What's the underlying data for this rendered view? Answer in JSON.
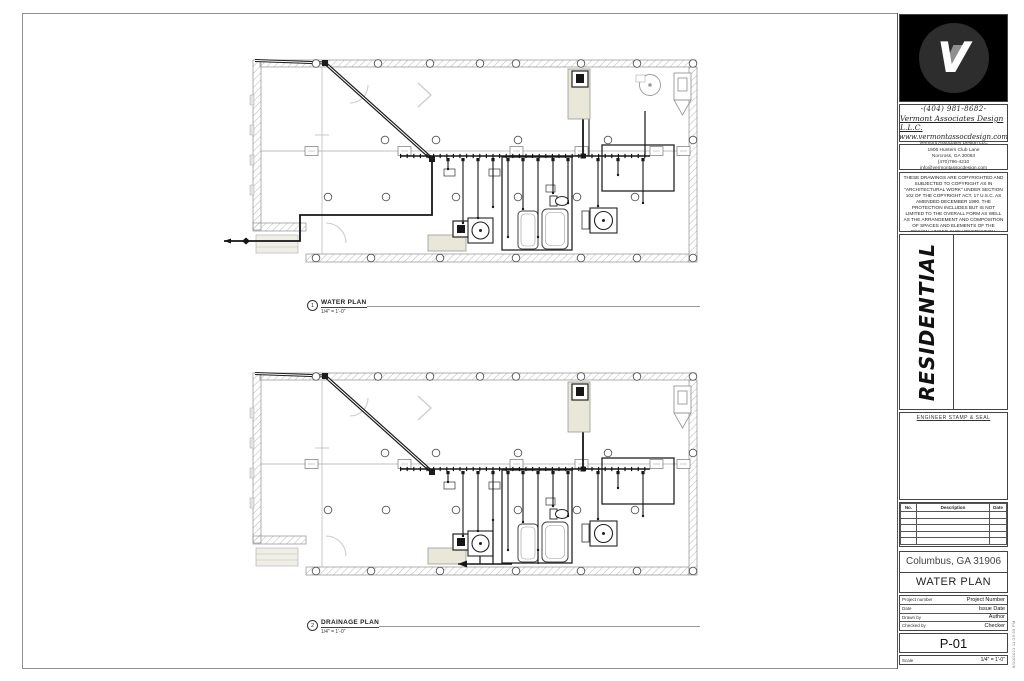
{
  "plans": [
    {
      "number": "1",
      "title": "WATER PLAN",
      "scale": "1/4\" = 1'-0\"",
      "variant": "water"
    },
    {
      "number": "2",
      "title": "DRAINAGE PLAN",
      "scale": "1/4\" = 1'-0\"",
      "variant": "drainage"
    }
  ],
  "titleblock": {
    "logo_letter": "V",
    "phone": "-(404) 981-8682-",
    "company": "Vermont Associates Design L.L.C.",
    "website": "www.vermontassocdesign.com",
    "address_lines": [
      "Vermont Associates Design LLC",
      "1906 Hunters Club Lane",
      "Norcross, GA 30093",
      "(470)796-4210",
      "info@vermontassocdesign.com"
    ],
    "copyright": "THESE DRAWINGS ARE COPYRIGHTED AND SUBJECTED TO COPYRIGHT AS IN \"ARCHITECTURAL WORK\" UNDER SECTION 102 OF THE COPYRIGHT ACT, 17 U.S.C. AS AMENDED DECEMBER 1990. THE PROTECTION INCLUDES BUT IS NOT LIMITED TO THE OVERALL FORM AS WELL AS THE ARRANGEMENT AND COMPOSITION OF SPACES AND ELEMENTS OF THE DESIGN. UNDER SUCH PROTECTION, UNAUTHORIZED USE OF THESE PLANS, WORK OR HOME REPRESENTATION OF CONSTRUCTION OR BUILDING BEING SEIZED AND OR MONETARY COMPENSATION TO VERMONT ASSOCIATES DESIGN LLC.",
    "project_type": "RESIDENTIAL",
    "stamp_label": "ENGINEER STAMP & SEAL",
    "revision_table": {
      "headers": [
        "No.",
        "Description",
        "Date"
      ],
      "rows": 5
    },
    "location": "Columbus, GA 31906",
    "sheet_title": "WATER PLAN",
    "info_rows": [
      {
        "label": "Project number",
        "value": "Project Number"
      },
      {
        "label": "Date",
        "value": "Issue Date"
      },
      {
        "label": "Drawn by",
        "value": "Author"
      },
      {
        "label": "Checked by",
        "value": "Checker"
      }
    ],
    "sheet_number": "P-01",
    "scale_label": "Scale",
    "scale_value": "1/4\" = 1'-0\"",
    "plot_stamp": "8/10/2021 11:29:50 PM"
  }
}
